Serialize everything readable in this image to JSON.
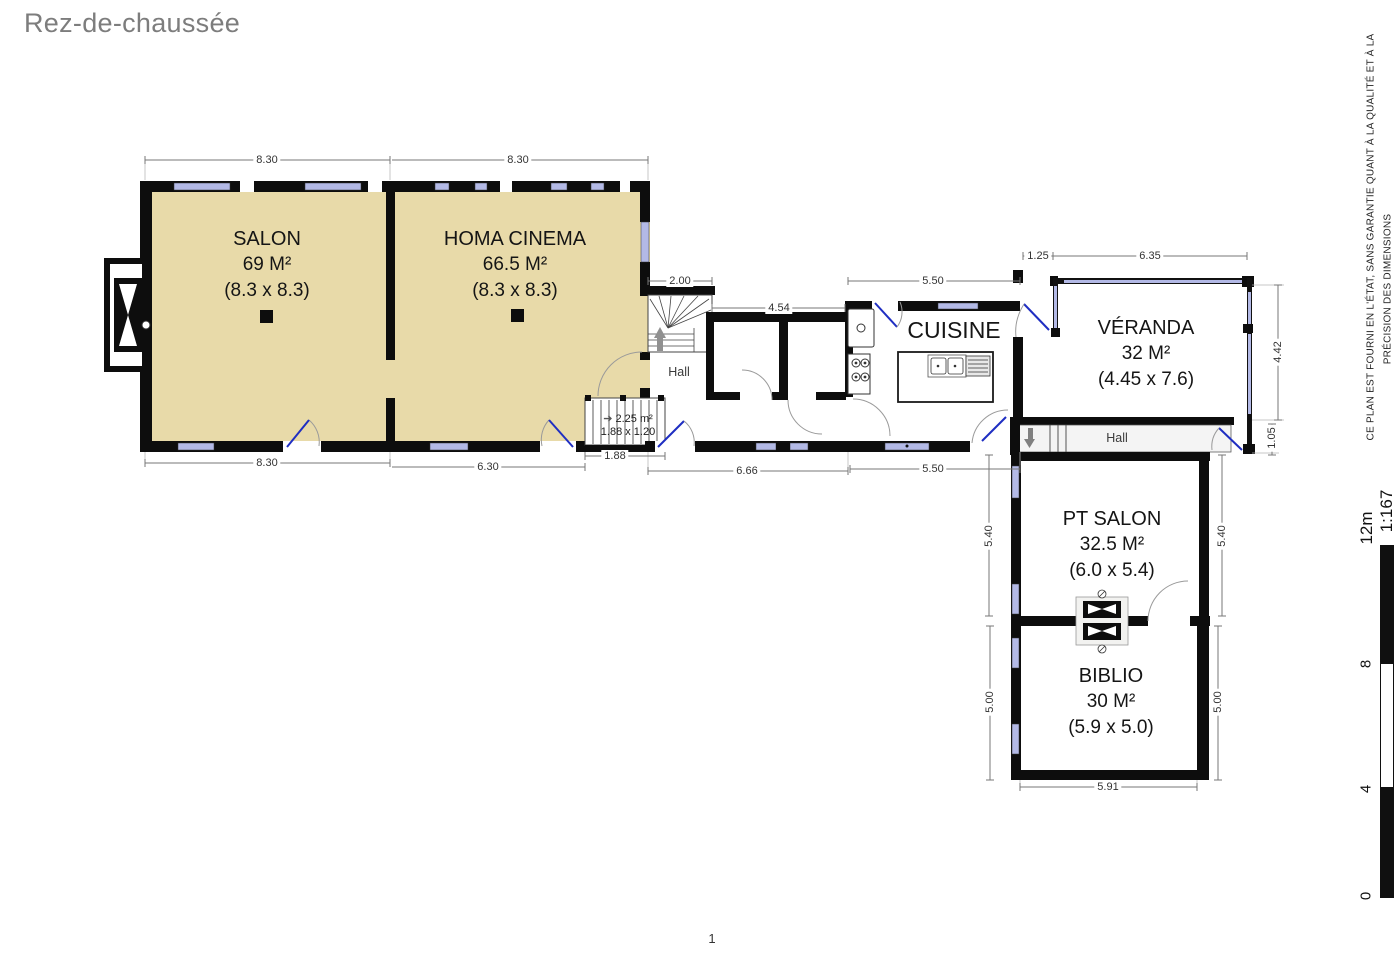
{
  "header": {
    "title": "Rez-de-chaussée"
  },
  "footer": {
    "page_number": "1"
  },
  "plan": {
    "rooms": {
      "salon": {
        "name": "SALON",
        "area": "69 M²",
        "size": "(8.3 x 8.3)"
      },
      "cinema": {
        "name": "HOMA CINEMA",
        "area": "66.5 M²",
        "size": "(8.3 x 8.3)"
      },
      "cuisine": {
        "name": "CUISINE"
      },
      "veranda": {
        "name": "VÉRANDA",
        "area": "32 M²",
        "size": "(4.45 x 7.6)"
      },
      "pt_salon": {
        "name": "PT SALON",
        "area": "32.5 M²",
        "size": "(6.0 x 5.4)"
      },
      "biblio": {
        "name": "BIBLIO",
        "area": "30 M²",
        "size": "(5.9 x 5.0)"
      }
    },
    "halls": {
      "center": "Hall",
      "right": "Hall"
    },
    "stairs_note": {
      "area": "2.25 m²",
      "size": "1.88 x 1.20"
    },
    "dims": {
      "salon_top": "8.30",
      "cinema_top": "8.30",
      "stair_top": "2.00",
      "storage_top": "4.54",
      "cuisine_top": "5.50",
      "veranda_offset": "1.25",
      "veranda_top": "6.35",
      "veranda_right": "4.42",
      "veranda_right_small": "1.05",
      "salon_bottom": "8.30",
      "cinema_bottom": "6.30",
      "stair_bottom": "1.88",
      "corridor_bottom": "6.66",
      "cuisine_bottom": "5.50",
      "pt_salon_left": "5.40",
      "pt_salon_right": "5.40",
      "biblio_left": "5.00",
      "biblio_right": "5.00",
      "biblio_bottom": "5.91"
    }
  },
  "sidebar": {
    "disclaimer": {
      "line1": "CE PLAN EST FOURNI EN L'ÉTAT, SANS GARANTIE QUANT À LA QUALITÉ ET À LA",
      "line2": "PRÉCISION DES DIMENSIONS"
    },
    "scale": {
      "ratio": "1:167",
      "max_label": "12m",
      "tick_8": "8",
      "tick_4": "4",
      "tick_0": "0"
    }
  },
  "icons": {
    "stairs_direction_arrow": "➔"
  },
  "colors": {
    "room_fill": "#e8daa9",
    "wall": "#0d0d0d",
    "window_glazing": "#b3b9e6",
    "door_leaf": "#1f2ec2",
    "dimension_line": "#777777",
    "title_text": "#7d7d7d",
    "hall_floor": "#f4f4f4"
  }
}
